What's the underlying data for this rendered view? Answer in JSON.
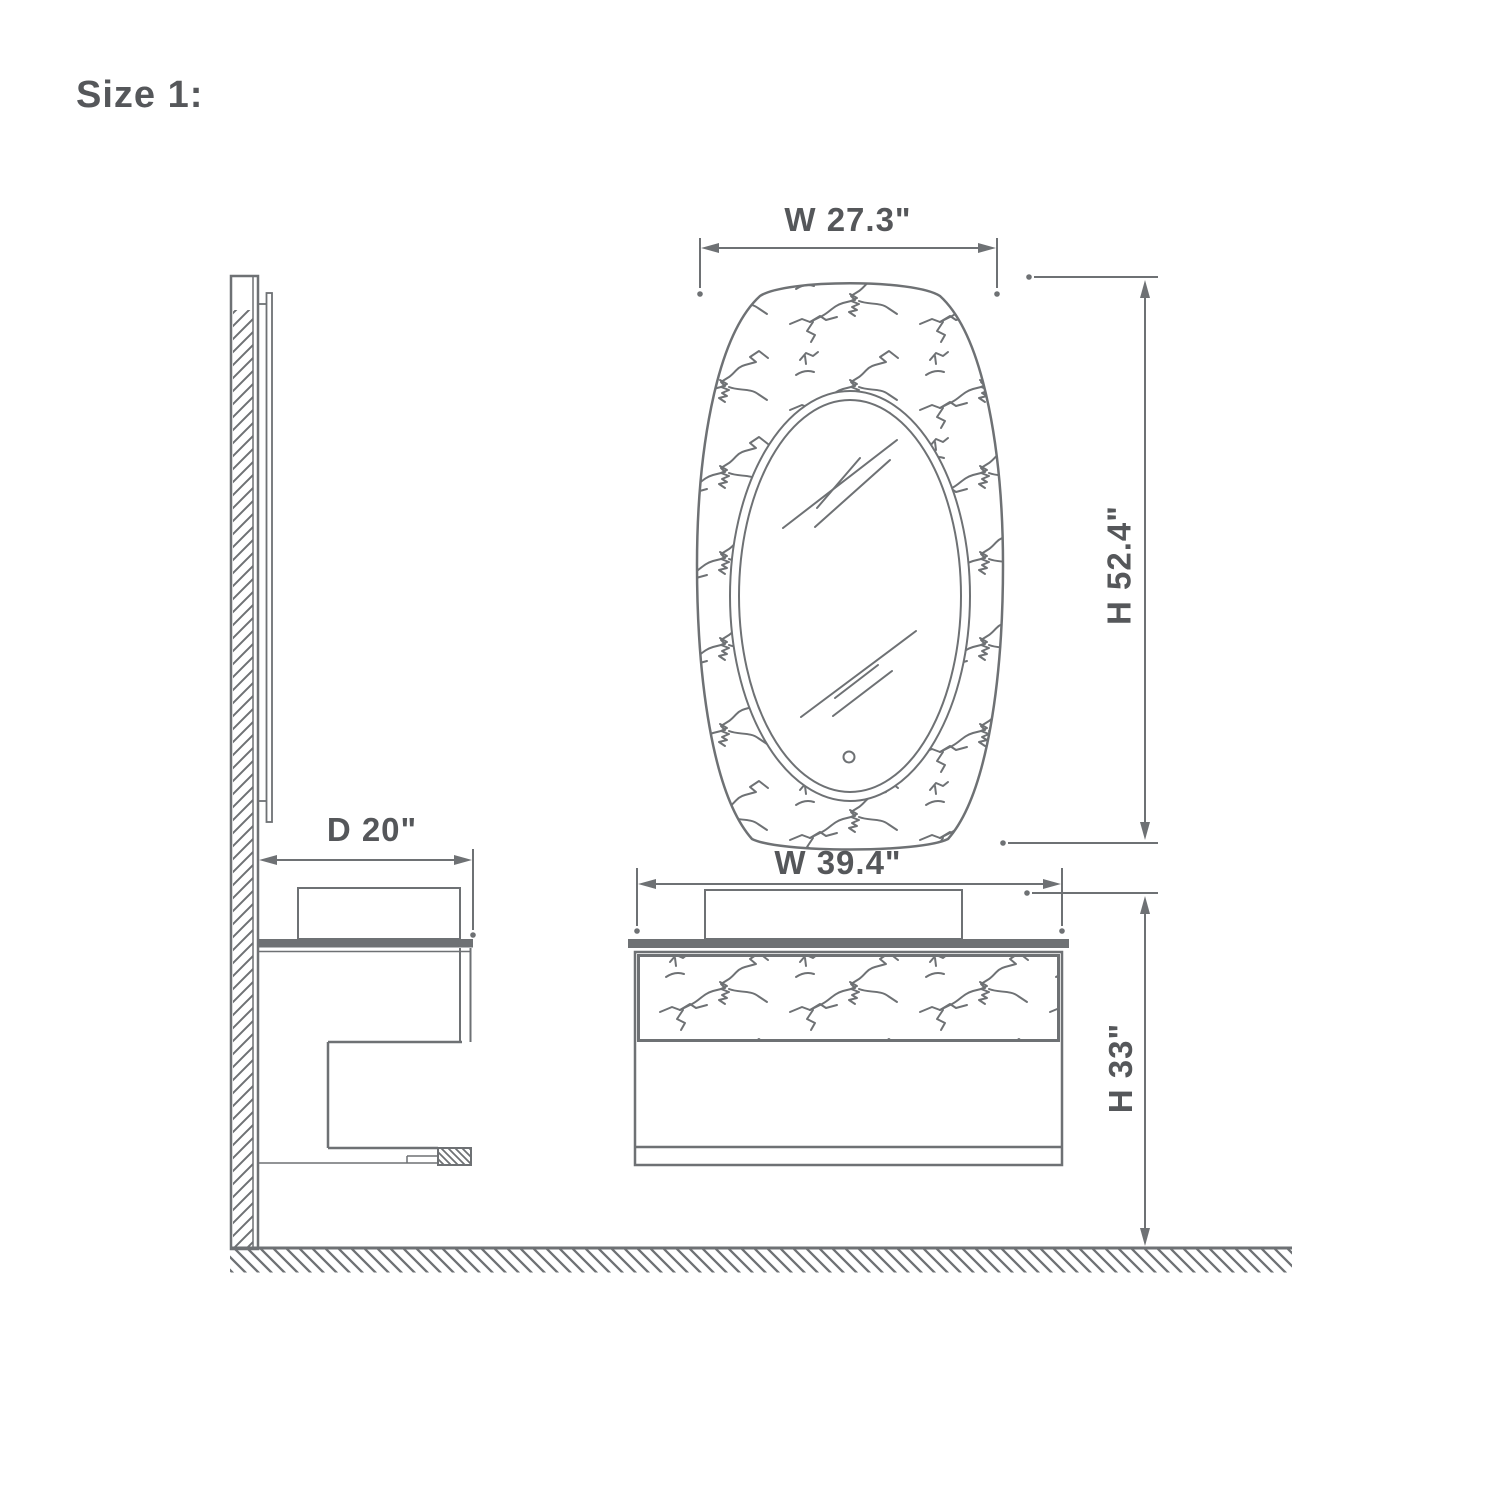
{
  "title": "Size 1:",
  "drawing_type": "bathroom-vanity-dimension-diagram",
  "dimensions": {
    "mirror_width": "W 27.3\"",
    "mirror_height": "H 52.4\"",
    "vanity_width": "W 39.4\"",
    "vanity_height": "H 33\"",
    "vanity_depth": "D 20\""
  },
  "colors": {
    "line": "#6e7174",
    "text": "#55575a",
    "background": "#ffffff"
  }
}
